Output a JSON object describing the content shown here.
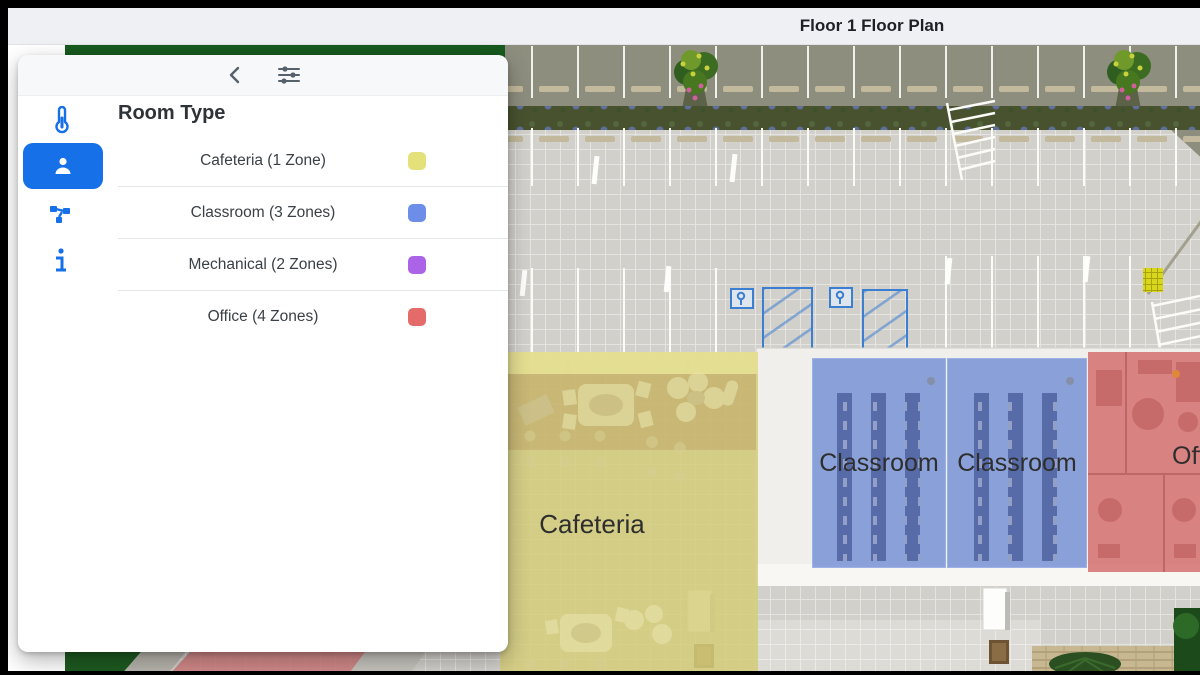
{
  "window": {
    "title": "Floor 1 Floor Plan"
  },
  "panel": {
    "title": "Room Type",
    "header": {
      "back_icon": "chevron-left",
      "filter_icon": "sliders"
    },
    "rail": {
      "items": [
        {
          "name": "temperature",
          "icon": "thermometer-icon",
          "active": false
        },
        {
          "name": "occupancy",
          "icon": "person-icon",
          "active": true
        },
        {
          "name": "network",
          "icon": "share-nodes-icon",
          "active": false
        },
        {
          "name": "info",
          "icon": "info-icon",
          "active": false
        }
      ]
    },
    "legend": {
      "rows": [
        {
          "label": "Cafeteria (1 Zone)",
          "color": "#e4e17b"
        },
        {
          "label": "Classroom (3 Zones)",
          "color": "#6c8ee9"
        },
        {
          "label": "Mechanical (2 Zones)",
          "color": "#ab64e8"
        },
        {
          "label": "Office (4 Zones)",
          "color": "#e56a6a"
        }
      ]
    }
  },
  "map": {
    "zones": [
      {
        "label": "Cafeteria",
        "color": "#d5cd7a"
      },
      {
        "label": "Classroom",
        "color": "#6d89d4"
      },
      {
        "label": "Classroom",
        "color": "#6d89d4"
      },
      {
        "label": "Office",
        "color": "#d26767"
      }
    ]
  },
  "accent": "#1670e8"
}
